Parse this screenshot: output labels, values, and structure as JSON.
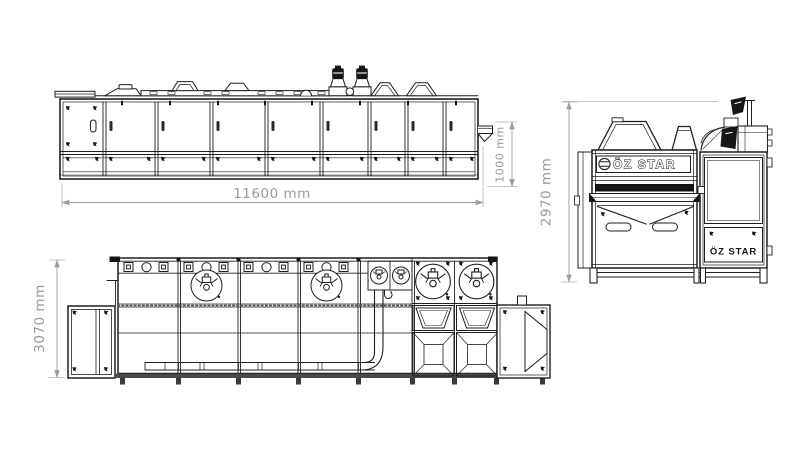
{
  "drawing": {
    "brand": "ÖZ STAR",
    "views": {
      "side_elevation": {
        "dim_length": "11600 mm",
        "dim_discharge_height": "1000 mm"
      },
      "end_elevation": {
        "dim_height": "2970 mm",
        "logo_primary": "ÖZ STAR",
        "logo_secondary": "ÖZ STAR"
      },
      "plan": {
        "dim_width": "3070 mm"
      }
    },
    "colors": {
      "line": "#1f1f1f",
      "dimension_gray": "#9c9c9c",
      "background": "#ffffff"
    }
  }
}
